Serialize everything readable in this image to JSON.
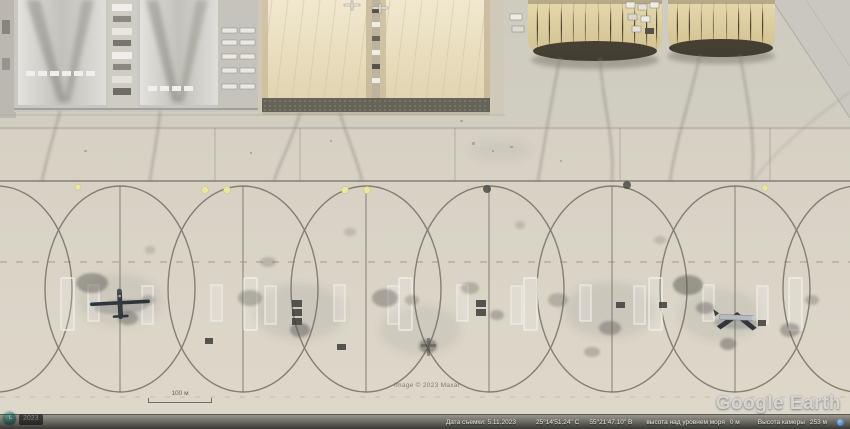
{
  "app": {
    "name": "Google Earth"
  },
  "watermarks": {
    "logo": "Google Earth",
    "attribution": "Image © 2023 Maxar"
  },
  "scale_bar": {
    "label": "100 м"
  },
  "history": {
    "year_chip": "2023"
  },
  "status_bar": {
    "imagery_date": "Дата съемки: 5.11.2023",
    "latitude": "25°14'51.24\" С",
    "longitude": "55°21'47.10\" В",
    "elevation_label": "высота над уровнем моря",
    "elevation": "0 м",
    "camera_label": "Высота камеры",
    "camera_altitude": "253 м"
  },
  "icons": {
    "history_clock": "clock-icon",
    "status_dot": "blue-dot-icon"
  },
  "colors": {
    "apron": "#d6d1c4",
    "hangar_cream": "#e9dec0",
    "hangar_tan": "#dccfa0",
    "taxiline": "#6e6a5f",
    "status_bar_text": "#e9e8e4",
    "yellow_light": "#ece79f"
  },
  "scene": {
    "description_labels": {
      "left_hangars": "weathered-gray-hangars",
      "center_hangars": "cream-tension-hangars",
      "right_hangars": "quonset-hangars",
      "apron": "parking-apron-with-turn-loops",
      "aircraft_left": "parked-uav",
      "aircraft_right": "parked-light-aircraft"
    }
  }
}
